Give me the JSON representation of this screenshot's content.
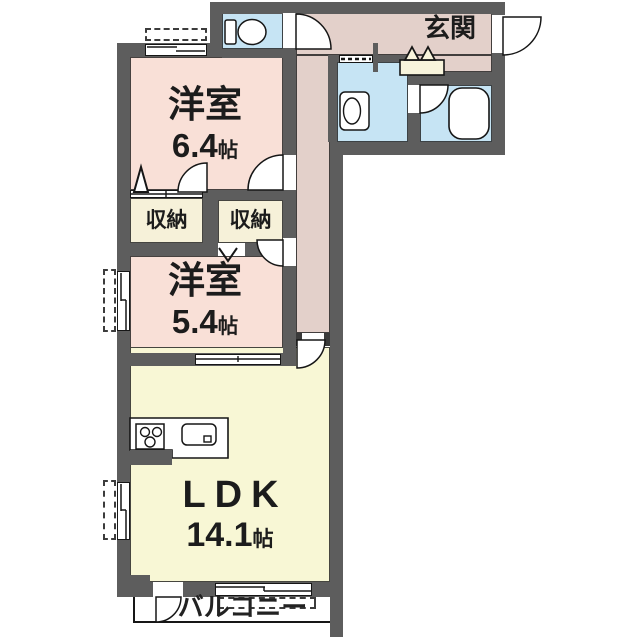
{
  "rooms": {
    "entrance": {
      "label": "玄関"
    },
    "bedroom1": {
      "label": "洋室",
      "size": "6.4",
      "unit": "帖"
    },
    "bedroom2": {
      "label": "洋室",
      "size": "5.4",
      "unit": "帖"
    },
    "closet_left": {
      "label": "収納"
    },
    "closet_right": {
      "label": "収納"
    },
    "ldk": {
      "label": "LDK",
      "size": "14.1",
      "unit": "帖"
    },
    "balcony": {
      "label": "バルコニー"
    }
  },
  "fixtures": [
    "toilet-icon",
    "washbasin-icon",
    "bathtub-icon",
    "stove-icon",
    "sink-icon",
    "shoe-cabinet-icon",
    "door-arc",
    "sliding-window"
  ],
  "colors": {
    "wall": "#5d5d5d",
    "bedroom": "#f9e0d7",
    "hallway": "#e3d0ca",
    "wetroom": "#c6e4f4",
    "closet": "#f6f1d9",
    "ldk": "#f8f7d5",
    "balcony": "#ffffff",
    "outline": "#1a1a1a"
  }
}
